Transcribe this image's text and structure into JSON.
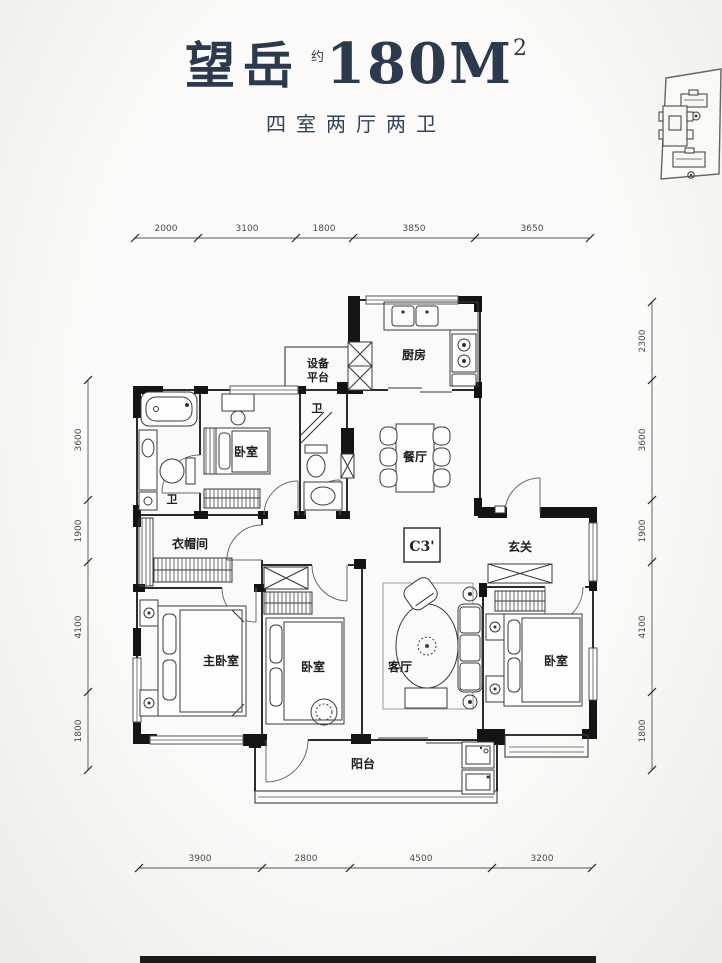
{
  "header": {
    "project_name": "望岳",
    "approx_prefix": "约",
    "area_value": "180M",
    "area_superscript": "2",
    "subtitle": "四室两厅两卫"
  },
  "plan": {
    "unit_label": "C3'",
    "rooms": {
      "equipment_platform_line1": "设备",
      "equipment_platform_line2": "平台",
      "kitchen": "厨房",
      "bath_top": "卫",
      "bedroom_top": "卧室",
      "bath_left": "卫",
      "dining": "餐厅",
      "entry": "玄关",
      "cloakroom": "衣帽间",
      "master_bedroom": "主卧室",
      "bedroom_middle": "卧室",
      "living_room": "客厅",
      "bedroom_right": "卧室",
      "balcony": "阳台"
    }
  },
  "dimensions": {
    "top": [
      "2000",
      "3100",
      "1800",
      "3850",
      "3650"
    ],
    "bottom": [
      "3900",
      "2800",
      "4500",
      "3200"
    ],
    "left": [
      "3600",
      "1900",
      "4100",
      "1800"
    ],
    "right": [
      "2300",
      "3600",
      "1900",
      "4100",
      "1800"
    ]
  },
  "colors": {
    "title_text": "#2c3a4e",
    "wall_line": "#2b2b2b",
    "wall_fill": "#141414",
    "dim_text": "#4a4a4a",
    "paper": "#f5f3f0"
  }
}
